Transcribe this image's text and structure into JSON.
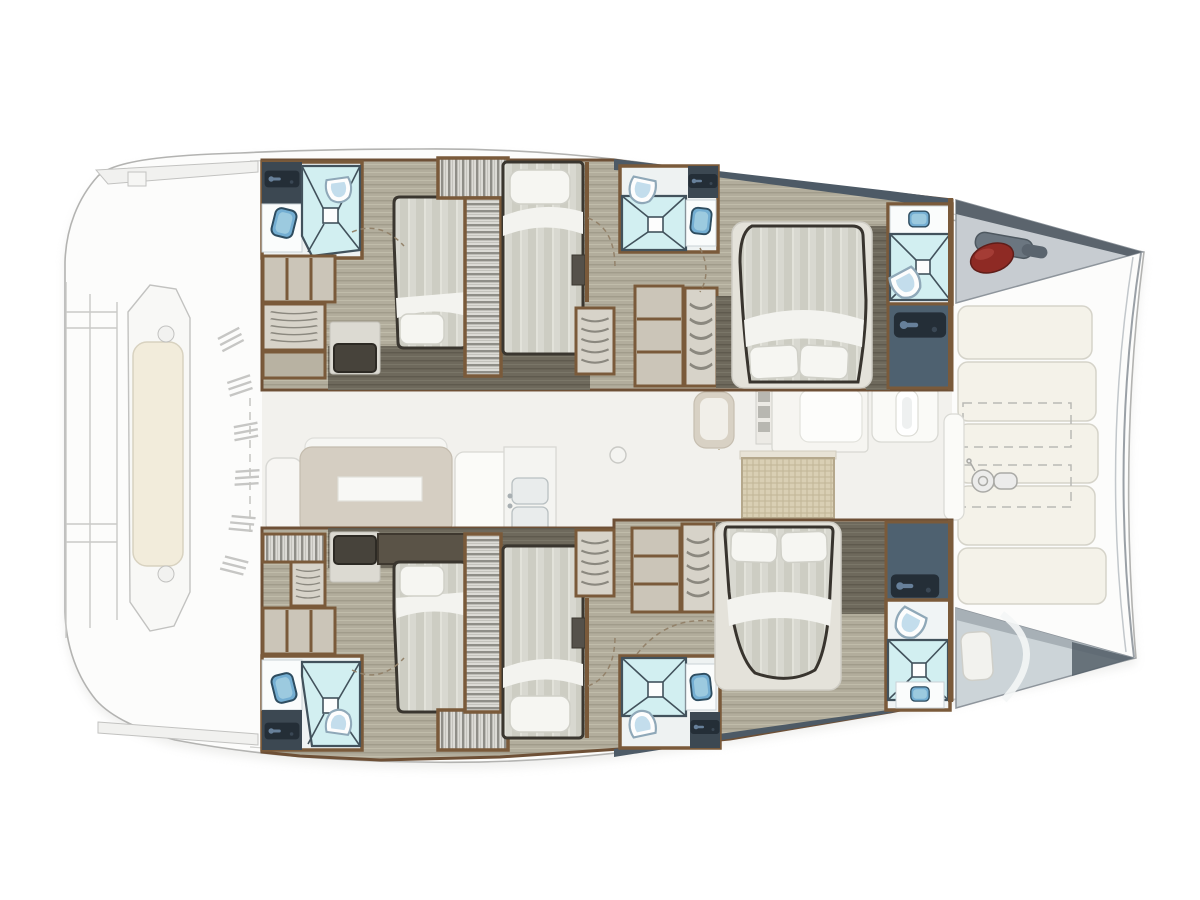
{
  "document": {
    "kind": "yacht-deck-floorplan",
    "view": "top-down",
    "vessel": "sailing-catamaran",
    "orientation": "bows-right-sterns-left",
    "visible_text": ""
  },
  "palette": {
    "background": "#ffffff",
    "hull_outline": "#b3b3b1",
    "deck_faded": "#f7f7f5",
    "wood_floor": "#b2ad9c",
    "wood_dark": "#6e695c",
    "wall_brown": "#7a5a3a",
    "slate_entry": "#4e6170",
    "door_panel": "#242e37",
    "shower_tile": "#d2eff1",
    "shower_line": "#42525c",
    "sink_blue": "#74aed2",
    "toilet_bowl": "#c3ddec",
    "duvet": "#d6d6cd",
    "pillow": "#f6f6f2",
    "sunpad_cream": "#f4f2e9",
    "salon_sofa_beige": "#d5cec2",
    "wicker_table": "#d9cfb4",
    "forepeak_grey": "#c7ccd1",
    "fender_red": "#8e2a24",
    "windlass_grey": "#6b7680"
  },
  "inventory": {
    "hulls": [
      "port-hull-top",
      "starboard-hull-bottom"
    ],
    "rooms_per_hull": [
      "aft-head",
      "aft-double-cabin",
      "mid-single-cabin",
      "mid-head",
      "forward-double-cabin",
      "forward-head",
      "forepeak-berth"
    ],
    "fixtures": {
      "double_beds": 4,
      "single_beds": 2,
      "forepeak_cushions": 2,
      "heads_bathrooms": 6,
      "showers": 6,
      "toilets": 6,
      "sinks": 6,
      "wardrobes_lockers": 14
    },
    "deck_features": [
      "stern-bench-cushion",
      "swim-platform-steps",
      "engine-vent-louvers",
      "salon-sofa",
      "salon-coffee-table",
      "galley-double-sink",
      "galley-counter",
      "galley-fridge",
      "wicker-cocktail-table",
      "foredeck-sunpads",
      "foredeck-storage-outlines",
      "anchor-windlass",
      "bow-fender",
      "bow-connecting-beam"
    ]
  }
}
